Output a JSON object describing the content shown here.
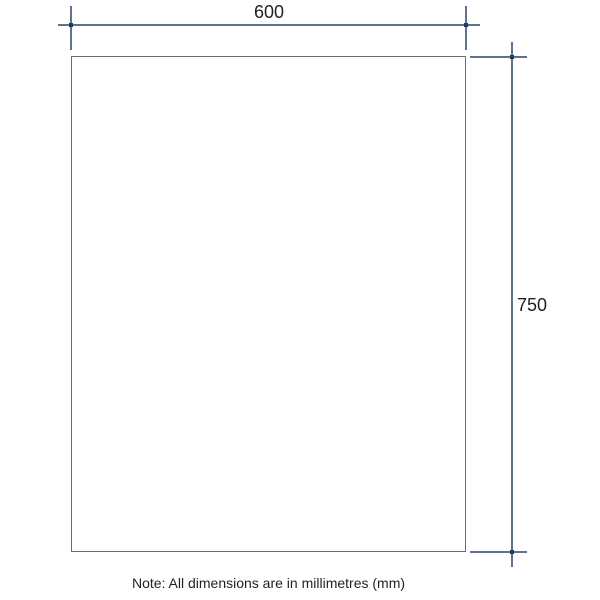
{
  "drawing": {
    "dimensions": {
      "width": {
        "label": "600"
      },
      "height": {
        "label": "750"
      }
    },
    "note": "Note: All dimensions are in millimetres (mm)",
    "unit": "mm"
  },
  "colors": {
    "background": "#ffffff",
    "panel_outline": "#6e6e6e",
    "dimension_line": "#5f7390",
    "dimension_marker": "#1d3869",
    "text": "#231f20"
  }
}
